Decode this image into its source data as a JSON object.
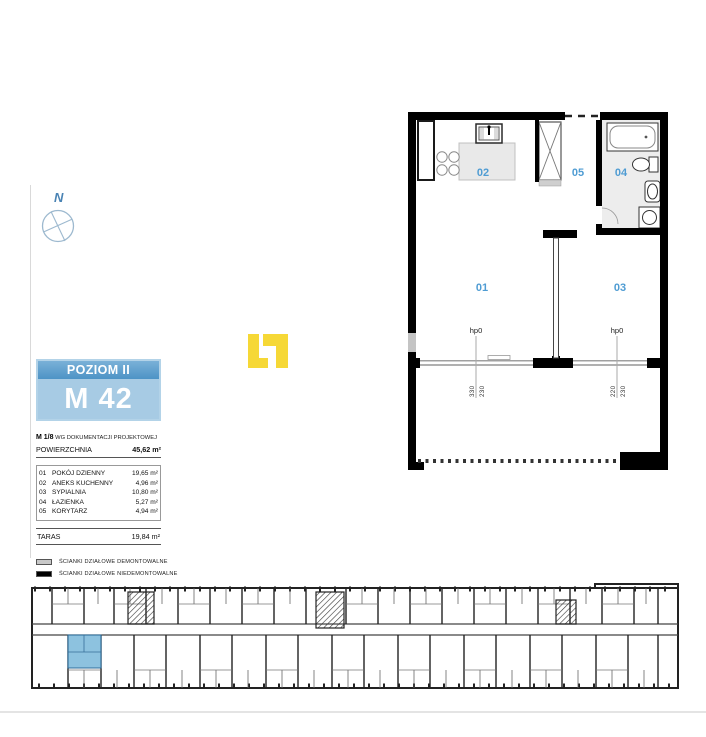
{
  "compass": {
    "label": "N"
  },
  "unit_card": {
    "level_label": "POZIOM II",
    "unit_label": "M 42",
    "doc_bold": "M 1/8",
    "doc_rest": " WG DOKUMENTACJI PROJEKTOWEJ",
    "area_label": "POWIERZCHNIA",
    "area_value": "45,62 m²",
    "rooms": [
      {
        "no": "01",
        "name": "POKÓJ DZIENNY",
        "area": "19,65 m²"
      },
      {
        "no": "02",
        "name": "ANEKS KUCHENNY",
        "area": "4,96 m²"
      },
      {
        "no": "03",
        "name": "SYPIALNIA",
        "area": "10,80 m²"
      },
      {
        "no": "04",
        "name": "ŁAZIENKA",
        "area": "5,27 m²"
      },
      {
        "no": "05",
        "name": "KORYTARZ",
        "area": "4,94 m²"
      }
    ],
    "taras_label": "TARAS",
    "taras_area": "19,84 m²"
  },
  "legend": {
    "items": [
      {
        "swatch_color": "#C8C8C8",
        "label": "ŚCIANKI DZIAŁOWE DEMONTOWALNE"
      },
      {
        "swatch_color": "#000000",
        "label": "ŚCIANKI DZIAŁOWE NIEDEMONTOWALNE"
      }
    ]
  },
  "floor_plan": {
    "room_labels": [
      "01",
      "02",
      "03",
      "04",
      "05"
    ],
    "windows": [
      {
        "hp": "hp0",
        "dim_a": "330",
        "dim_b": "230"
      },
      {
        "hp": "hp0",
        "dim_a": "220",
        "dim_b": "230"
      }
    ]
  },
  "colors": {
    "accent_blue": "#4F9CD3",
    "header_bar": "#5B9DCB",
    "header_bar_light": "#A7CBE4",
    "highlight_unit": "#79B7D9",
    "logo_yellow": "#F6D836",
    "wall_black": "#000000",
    "partition_gray": "#C8C8C8"
  }
}
